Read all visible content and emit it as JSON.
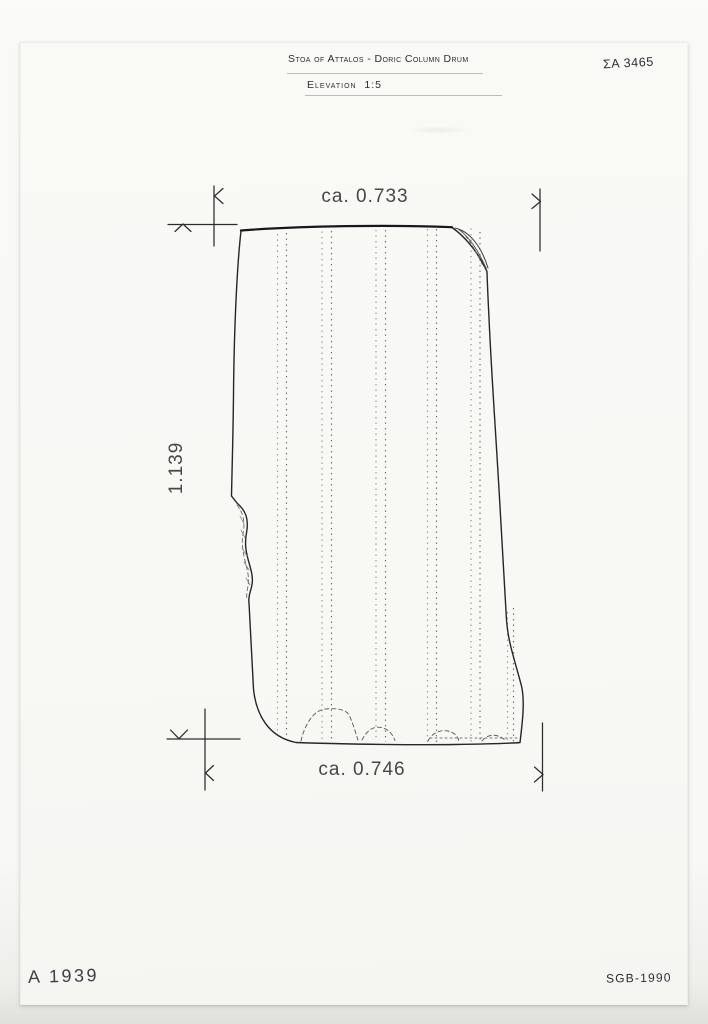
{
  "sheet": {
    "title": "Stoa of Attalos - Doric Column Drum",
    "subtitle": "Elevation  1:5",
    "catalog_number": "ΣA 3465",
    "inventory_number": "A 1939",
    "credit": "SGB-1990"
  },
  "dimensions": {
    "top_width": "ca. 0.733",
    "bottom_width": "ca. 0.746",
    "height": "1.139"
  },
  "drawing": {
    "subject": "doric-column-drum",
    "view": "elevation",
    "scale": "1:5",
    "features": [
      "fluting arrises (dotted)",
      "broken top-right corner",
      "spall on left edge",
      "weathered bottom edge"
    ]
  },
  "colors": {
    "paper": "#f8f8f5",
    "background": "#e9eae6",
    "ink": "#2b2d33",
    "outline": "#26262a",
    "dotted_line": "#6b6b64",
    "dimension_text": "#474747"
  }
}
